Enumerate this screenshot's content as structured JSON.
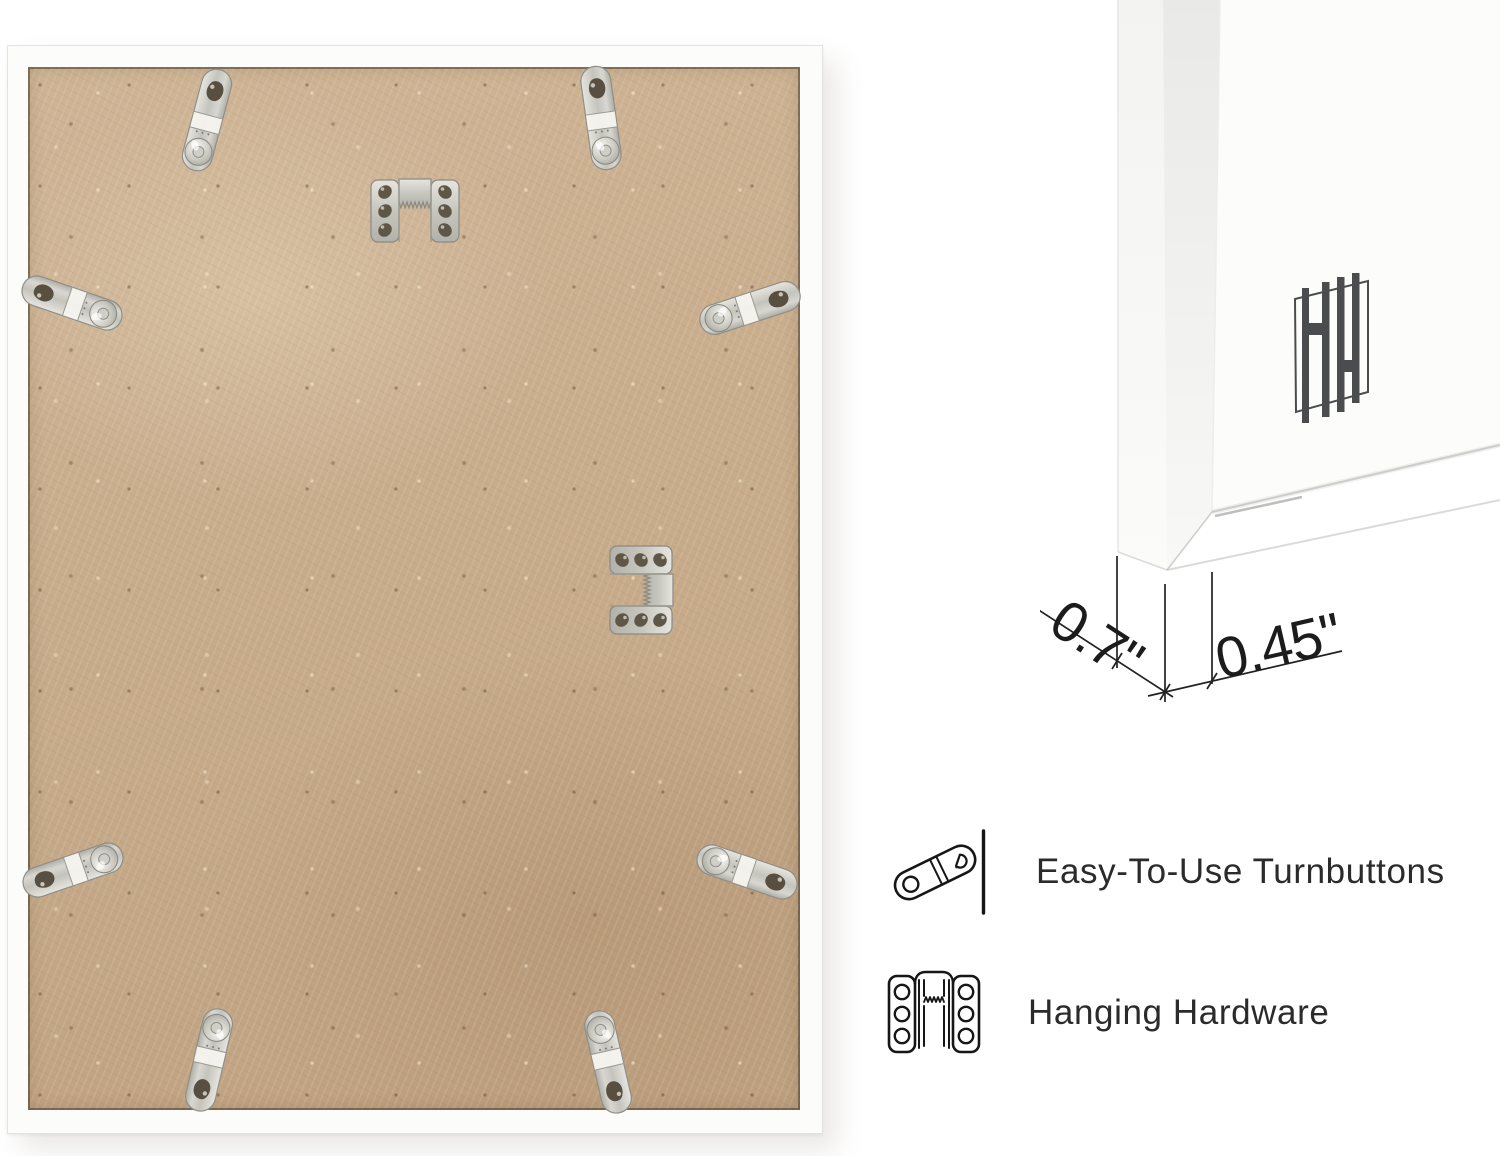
{
  "photo": {
    "view": "picture frame back with hanging hardware",
    "turnbutton_count": 8,
    "sawtooth_hanger_count": 2
  },
  "closeup": {
    "logo_icon": "hh-monogram-logo",
    "dimensions": {
      "frame_depth": "0.7\"",
      "frame_face_width": "0.45\""
    }
  },
  "features": [
    {
      "icon": "turnbutton-icon",
      "label": "Easy-To-Use Turnbuttons"
    },
    {
      "icon": "sawtooth-hanger-icon",
      "label": "Hanging Hardware"
    }
  ],
  "colors": {
    "backing_tan": "#c9ac8a",
    "metal_silver": "#d9d8d2",
    "frame_white": "#fcfcfb",
    "line_dark": "#222222",
    "logo_gray": "#4b4c4e"
  }
}
